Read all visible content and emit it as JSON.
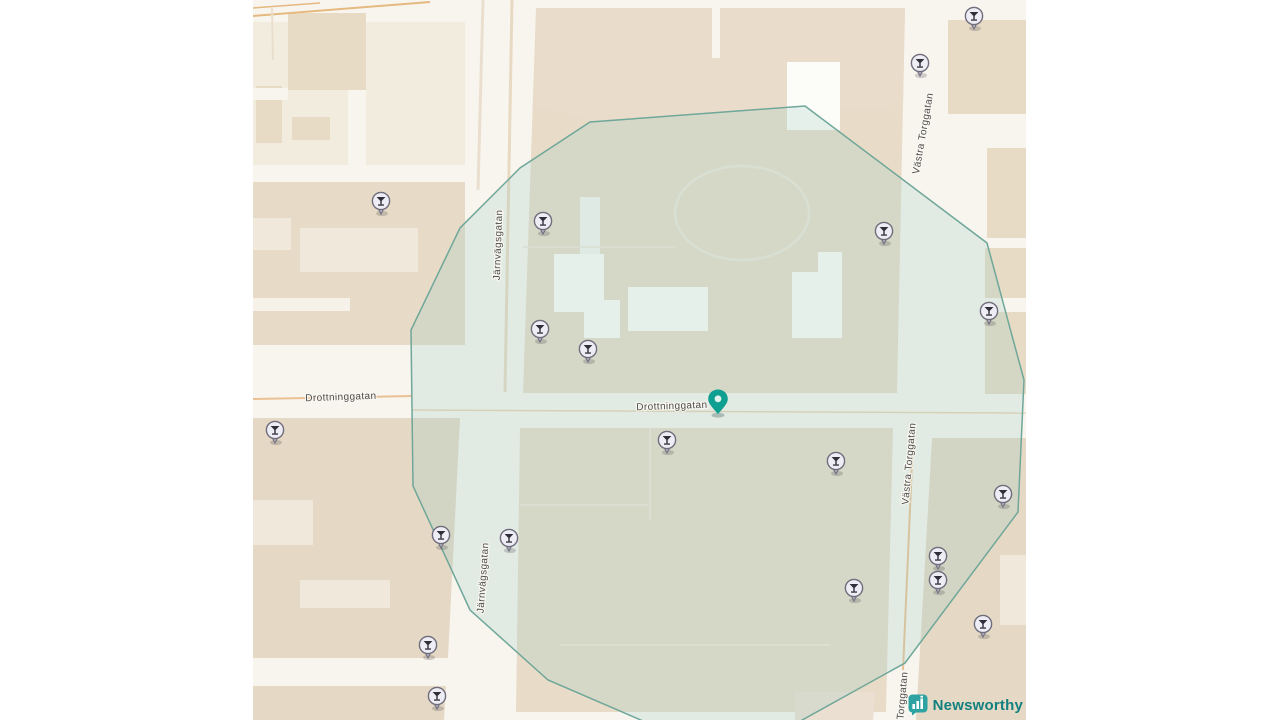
{
  "map": {
    "street_labels": [
      {
        "text": "Drottninggatan",
        "x": 341,
        "y": 400,
        "rotate": -2,
        "size": 9.5
      },
      {
        "text": "Drottninggatan",
        "x": 672,
        "y": 409,
        "rotate": -2,
        "size": 10
      },
      {
        "text": "Järnvägsgatan",
        "x": 501,
        "y": 245,
        "rotate": -88,
        "size": 10
      },
      {
        "text": "Järnvägsgatan",
        "x": 486,
        "y": 578,
        "rotate": -86,
        "size": 10
      },
      {
        "text": "Västra Torggatan",
        "x": 926,
        "y": 134,
        "rotate": -80,
        "size": 10
      },
      {
        "text": "Västra Torggatan",
        "x": 912,
        "y": 464,
        "rotate": -85,
        "size": 10
      },
      {
        "text": "Västra Torggatan",
        "x": 904,
        "y": 713,
        "rotate": -85,
        "size": 10
      }
    ],
    "poi_markers": [
      {
        "x": 974,
        "y": 16
      },
      {
        "x": 920,
        "y": 63
      },
      {
        "x": 381,
        "y": 201
      },
      {
        "x": 543,
        "y": 221
      },
      {
        "x": 884,
        "y": 231
      },
      {
        "x": 989,
        "y": 311
      },
      {
        "x": 540,
        "y": 329
      },
      {
        "x": 588,
        "y": 349
      },
      {
        "x": 667,
        "y": 440
      },
      {
        "x": 836,
        "y": 461
      },
      {
        "x": 275,
        "y": 430
      },
      {
        "x": 1003,
        "y": 494
      },
      {
        "x": 441,
        "y": 535
      },
      {
        "x": 509,
        "y": 538
      },
      {
        "x": 938,
        "y": 556
      },
      {
        "x": 938,
        "y": 580
      },
      {
        "x": 854,
        "y": 588
      },
      {
        "x": 983,
        "y": 624
      },
      {
        "x": 428,
        "y": 645
      },
      {
        "x": 437,
        "y": 696
      }
    ],
    "highlight_pin": {
      "x": 718,
      "y": 414,
      "color": "#0f9f90",
      "dot_color": "#dff2ee"
    },
    "geofence": {
      "stroke": "#6fa79a",
      "fill": "rgba(158,205,194,0.25)",
      "points": "805,106 987,243 1024,380 1018,512 905,663 795,724 650,724 548,680 470,610 413,486 411,330 460,228 520,168 590,122"
    }
  },
  "watermark": {
    "label": "Newsworthy",
    "brand_color": "#2ea3a1",
    "text_color": "#12807e"
  }
}
